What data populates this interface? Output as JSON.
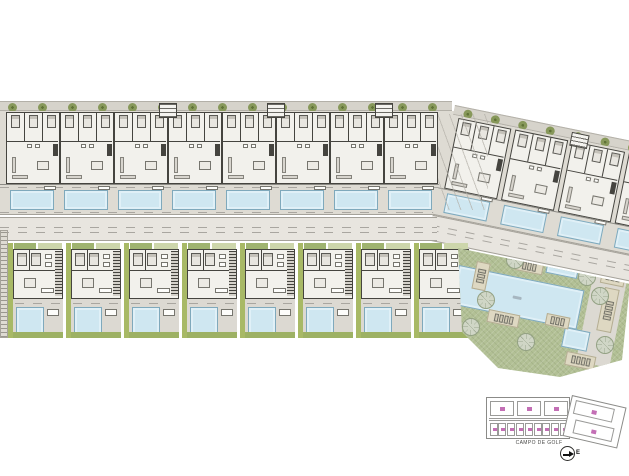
{
  "palette": {
    "paper": "#ffffff",
    "terrace_gray": "#dedbd3",
    "building_fill": "#f2f1ec",
    "wall_dark": "#45443f",
    "pool_blue": "#cfe7f1",
    "pool_edge": "#7fa9bc",
    "road_gray": "#e8e5df",
    "hedge_gray": "#d6d3cb",
    "tree_olive": "#87985a",
    "villa_green": "#a8b966",
    "lawn_green": "#9db164",
    "communal_green": "#b2c095",
    "lounger_beige": "#ded8c2",
    "keyplan_label_pink": "#c36fb5"
  },
  "site": {
    "top_row": {
      "apartment_units": 8,
      "entrance_stairs": 3,
      "private_pools": 8
    },
    "right_wing": {
      "apartment_units": 4,
      "entrance_stairs": 1,
      "private_pools": 4,
      "rotation_deg": 11.5
    },
    "villa_row": {
      "villas": 8,
      "private_pools": 8
    },
    "hedge": {
      "trees_top": 15,
      "trees_right": 9
    },
    "communal_area": {
      "main_pool": 1,
      "kids_pool": 1,
      "plunge_pool": 1,
      "sun_lounger_groups": 7,
      "trees": 8
    }
  },
  "key_plan": {
    "top_blocks": 3,
    "bottom_units": 9,
    "annex_blocks": 2,
    "caption": "CAMPO DE GOLF"
  },
  "north_arrow": {
    "label": "E"
  }
}
